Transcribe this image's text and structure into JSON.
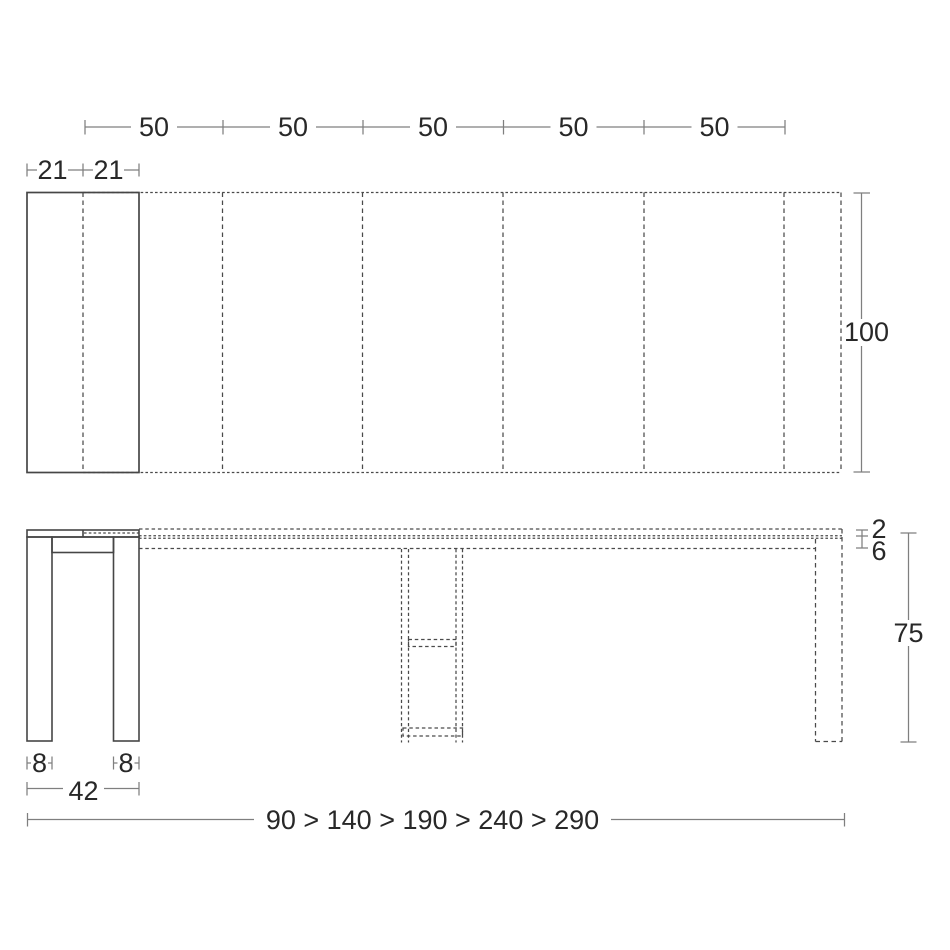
{
  "drawing": {
    "labels": {
      "extension_segments": [
        "50",
        "50",
        "50",
        "50",
        "50"
      ],
      "closed_halves": [
        "21",
        "21"
      ],
      "top_width": "100",
      "top_thickness": "2",
      "apron_height": "6",
      "table_height": "75",
      "leg_thickness": [
        "8",
        "8"
      ],
      "base_depth": "42",
      "length_sequence": "90 > 140 > 190 > 240 > 290"
    },
    "colors": {
      "background": "#ffffff",
      "geometry_line": "#464646",
      "dashed_line": "#4a4a4a",
      "dimension_line": "#7f7f7f",
      "text": "#282828"
    }
  }
}
